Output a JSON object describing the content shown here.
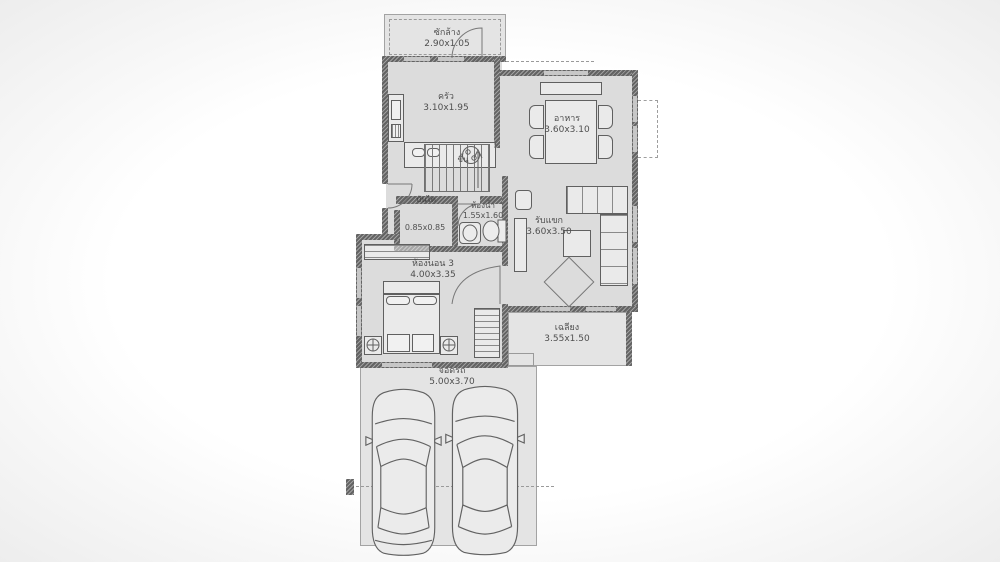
{
  "title": "house-floor-plan",
  "colors": {
    "floor": "#dcdcdc",
    "outdoor": "#e4e4e4",
    "wall": "#6e6e6e",
    "text": "#4f4f4f"
  },
  "rooms": {
    "laundry": {
      "name": "ซักล้าง",
      "dim": "2.90x1.05"
    },
    "kitchen": {
      "name": "ครัว",
      "dim": "3.10x1.95"
    },
    "dining": {
      "name": "อาหาร",
      "dim": "3.60x3.10"
    },
    "stairs": {
      "name": "ขึ้น"
    },
    "understair": {
      "name": "บันได",
      "dim": "0.85x0.85"
    },
    "bathroom": {
      "name": "ห้องน้ำ",
      "dim": "1.55x1.60"
    },
    "living": {
      "name": "รับแขก",
      "dim": "3.60x3.50"
    },
    "bedroom3": {
      "name": "ห้องนอน 3",
      "dim": "4.00x3.35"
    },
    "terrace": {
      "name": "เฉลียง",
      "dim": "3.55x1.50"
    },
    "carport": {
      "name": "จอดรถ",
      "dim": "5.00x3.70"
    }
  }
}
